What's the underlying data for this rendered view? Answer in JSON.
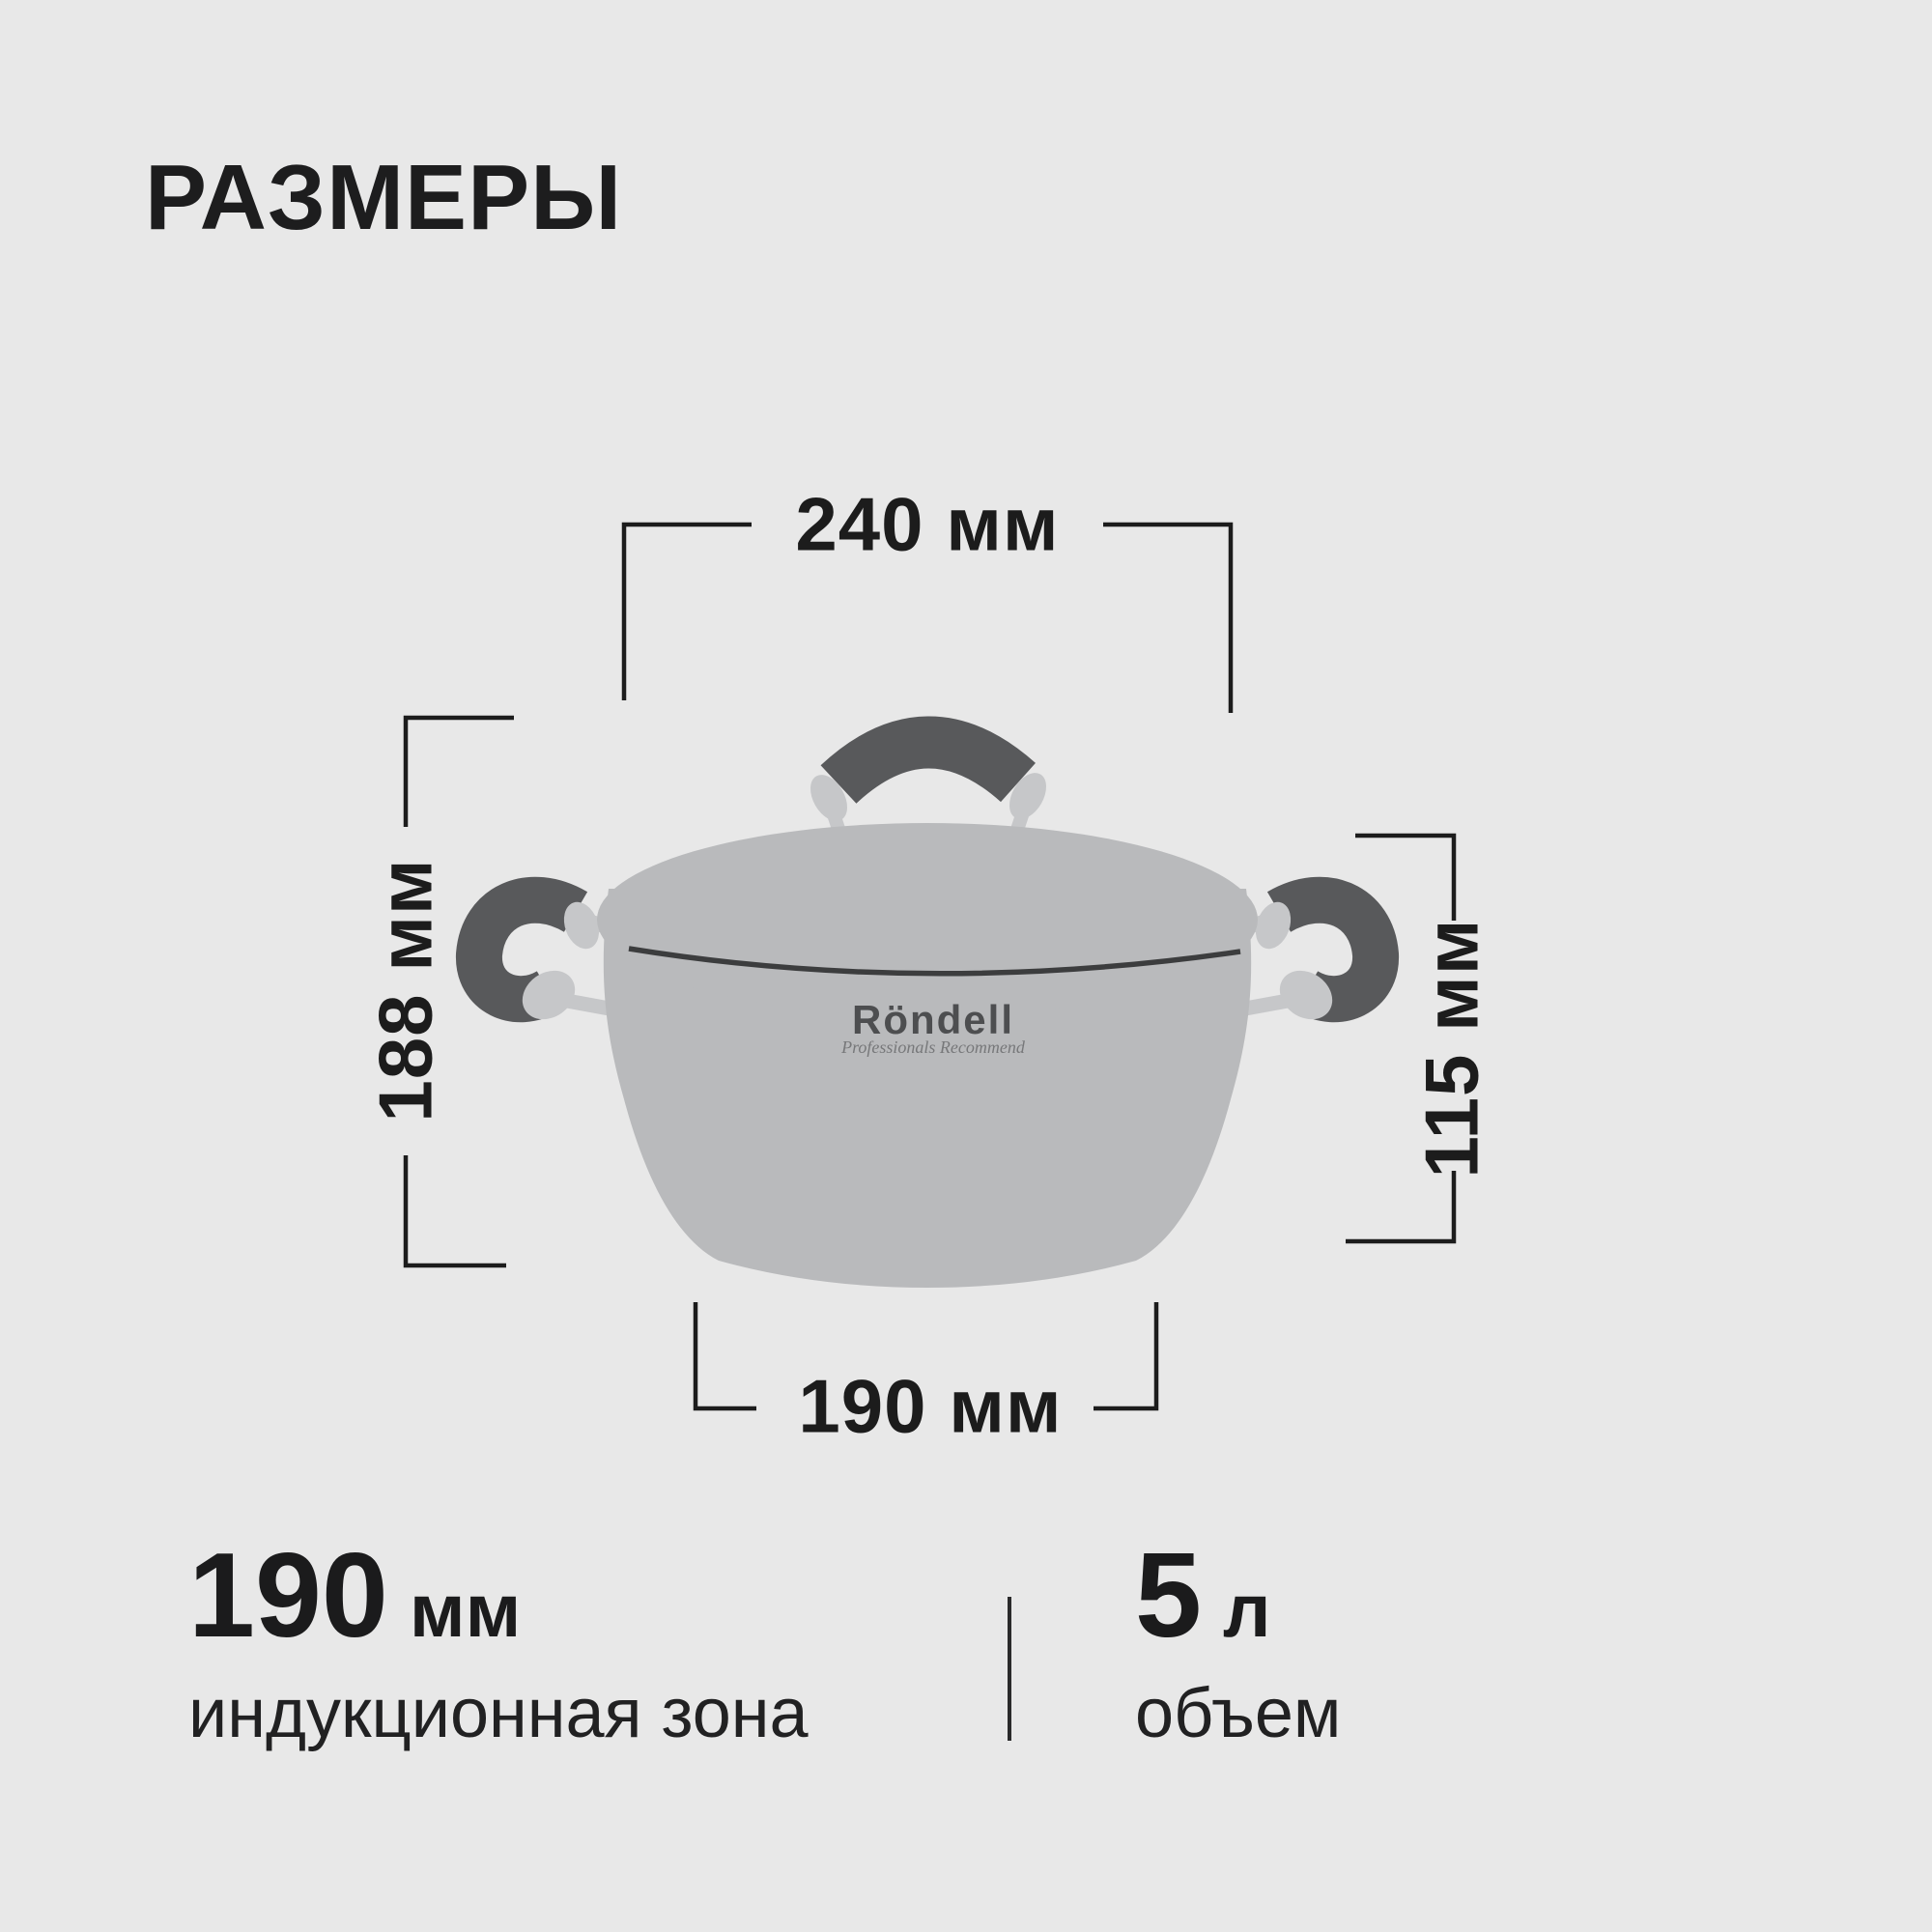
{
  "page": {
    "title": "РАЗМЕРЫ",
    "background_color": "#e8e8e8",
    "text_color": "#1d1d1e"
  },
  "diagram": {
    "line_color": "#1c1c1c",
    "dimensions": {
      "top_width": "240 мм",
      "left_height": "188 мм",
      "right_height": "115 мм",
      "bottom_width": "190 мм"
    },
    "pot": {
      "brand": "Röndell",
      "brand_tagline": "Professionals Recommend",
      "colors": {
        "body": "#b9babc",
        "handle_dark": "#58595b",
        "handle_silver": "#c6c7c9",
        "seam": "#3c3d3e",
        "brand_text": "#4d4e50",
        "tagline_text": "#77787a"
      }
    }
  },
  "specs": [
    {
      "value": "190",
      "unit": "мм",
      "label": "индукционная зона"
    },
    {
      "value": "5",
      "unit": "л",
      "label": "объем"
    }
  ]
}
